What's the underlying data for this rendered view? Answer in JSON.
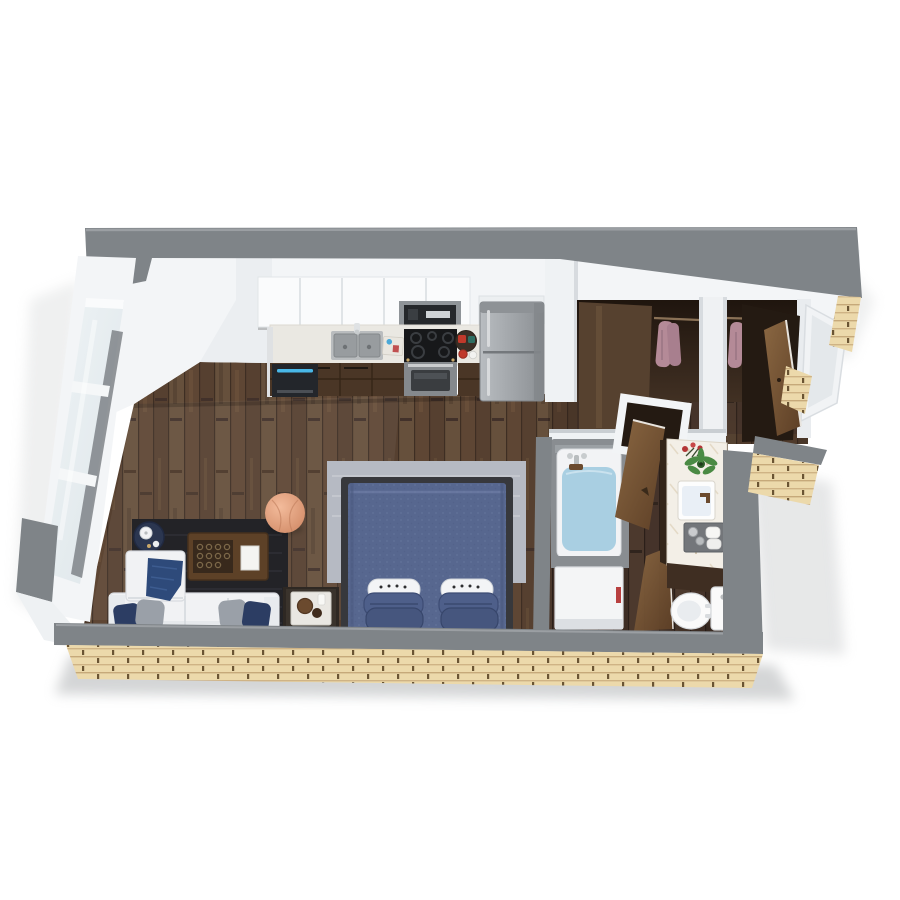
{
  "meta": {
    "description": "3D rendered top-down dollhouse floor plan of a studio apartment",
    "background": "#ffffff"
  },
  "palette": {
    "wall_gray": "#7f8488",
    "wall_gray_light": "#989da1",
    "wall_white": "#f3f5f7",
    "wall_white_shade": "#e3e7ea",
    "brick_tan": "#ecd9ab",
    "brick_mortar": "#c6a97a",
    "brick_dash": "#6a5433",
    "floor_wood": "#5e4634",
    "floor_wood_dark": "#44332a",
    "rug_dark": "#232327",
    "rug_light": "#b6bac3",
    "sofa_white": "#f1f2f4",
    "pillow_navy": "#2c3d63",
    "pillow_gray": "#9aa0a8",
    "throw_blue": "#2e4a7a",
    "pouf_peach": "#e8a988",
    "bed_blue": "#57678f",
    "bed_pillow_blue": "#4e5f8a",
    "bed_frame_dark": "#37383c",
    "table_brown": "#5d4127",
    "counter_white": "#eae8e2",
    "cabinet_brown": "#4a3626",
    "appliance_black": "#17181a",
    "stainless": "#a7abaf",
    "dishwasher_led_blue": "#49b8e8",
    "tub_water_blue": "#a9cfe2",
    "marble_white": "#f3efe7",
    "clothes_mauve": "#b48a97",
    "door_brown_light": "#8a6742",
    "door_brown_dark": "#5d3f26",
    "plant_green": "#4a8a44",
    "flower_red": "#b33636",
    "toilet_white": "#fafafa"
  },
  "rooms": {
    "kitchen": {
      "items": [
        "upper-cabinets",
        "microwave",
        "double-sink",
        "faucet",
        "prep-board",
        "cooktop",
        "oven",
        "serving-tray",
        "mugs",
        "base-cabinets",
        "dishwasher",
        "refrigerator"
      ]
    },
    "living_area": {
      "items": [
        "dark-area-rug",
        "sofa",
        "throw-blanket",
        "accent-pillows",
        "coffee-table",
        "decor-tray",
        "book",
        "round-side-table",
        "teapot",
        "pouf"
      ]
    },
    "sleeping_area": {
      "items": [
        "light-area-rug",
        "double-bed",
        "comforter",
        "white-accent-pillows",
        "blue-pillows",
        "nightstand",
        "tray-decor"
      ]
    },
    "bathroom": {
      "items": [
        "bathtub",
        "tub-faucet",
        "laundry-cabinet",
        "swing-door",
        "vanity-counter",
        "vanity-sink",
        "flowers",
        "potted-plant",
        "towel-tray",
        "toilet"
      ]
    },
    "closets": {
      "items": [
        "hanging-clothes",
        "sliding-door-panels",
        "closet-rod"
      ]
    },
    "entry": {
      "items": [
        "entry-door",
        "angled-vestibule-wall"
      ]
    },
    "shell": {
      "items": [
        "window-wall",
        "brick-exterior",
        "gray-wall-caps"
      ]
    }
  }
}
